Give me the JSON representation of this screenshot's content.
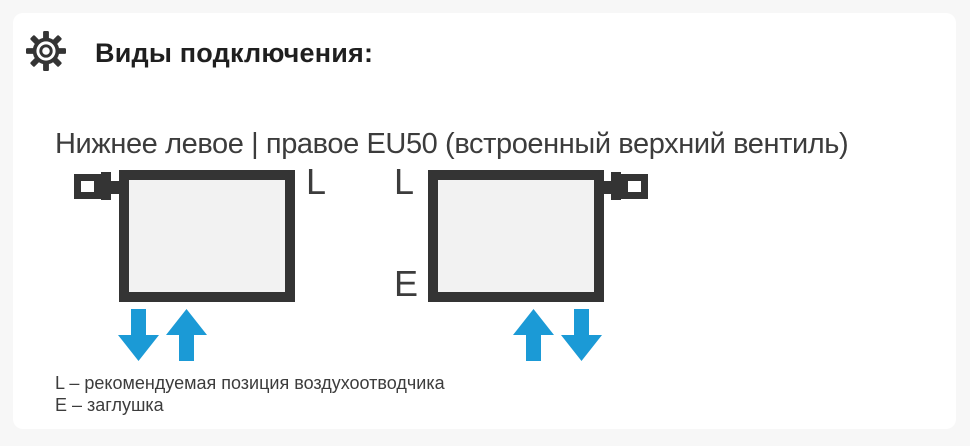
{
  "header": {
    "icon": "gear",
    "title": "Виды подключения:"
  },
  "subtitle": "Нижнее левое | правое EU50 (встроенный верхний вентиль)",
  "diagrams": {
    "left": {
      "air_vent_label": "L",
      "valve_side": "left",
      "arrows": [
        "down",
        "up"
      ]
    },
    "right": {
      "air_vent_label": "L",
      "plug_label": "E",
      "valve_side": "right",
      "arrows": [
        "up",
        "down"
      ]
    }
  },
  "legend": {
    "line1": "L – рекомендуемая позиция воздухоотводчика",
    "line2": "E – заглушка"
  },
  "colors": {
    "arrow_blue": "#1B9AD6",
    "outline_dark": "#343434",
    "radiator_fill": "#F2F2F2",
    "text_primary": "#1F1F1F",
    "text_secondary": "#3C3C3C",
    "card_bg": "#FFFFFF",
    "page_bg": "#F7F7F7"
  }
}
